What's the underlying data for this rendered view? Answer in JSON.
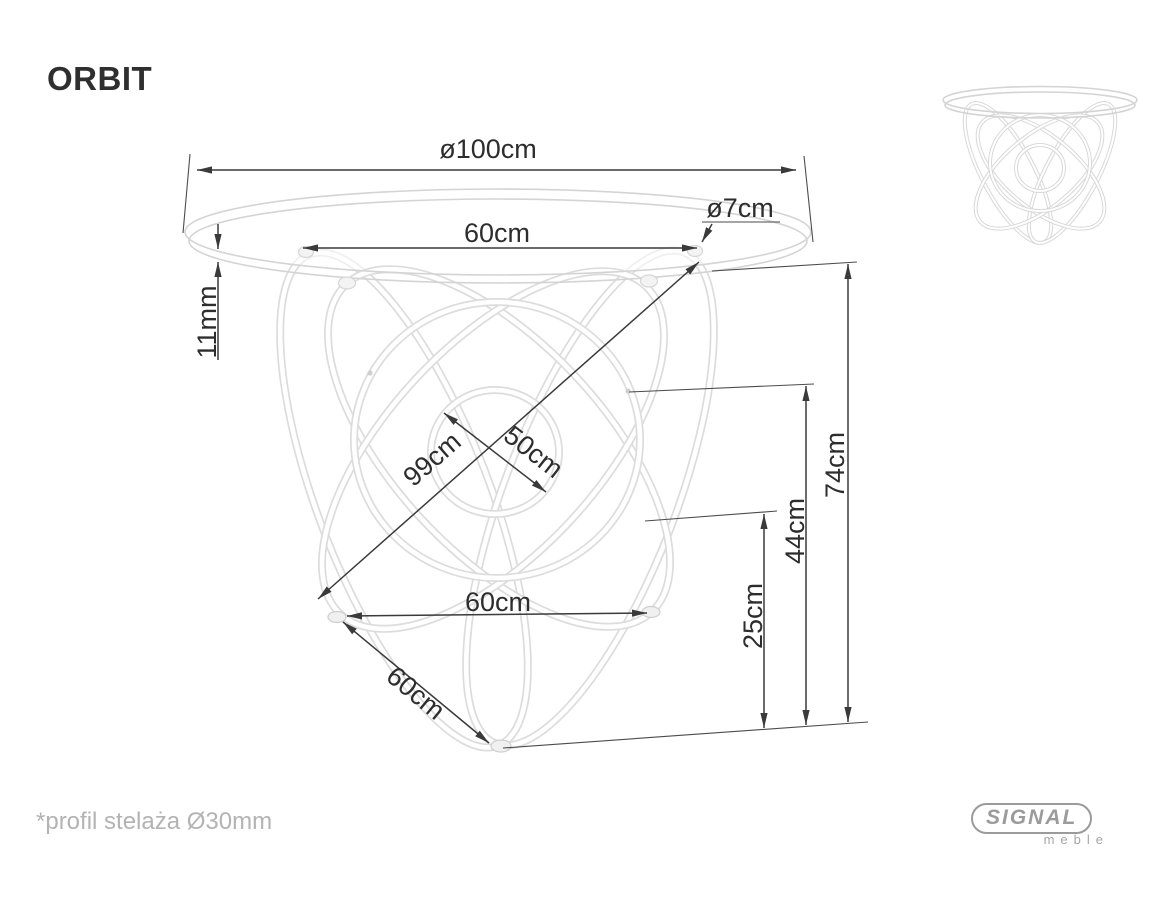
{
  "page": {
    "title": "ORBIT",
    "footnote": "*profil stelaża Ø30mm"
  },
  "logo": {
    "brand": "SIGNAL",
    "subtitle": "meble"
  },
  "drawing": {
    "dimensions": {
      "tabletop_diameter": "ø100cm",
      "top_mount_spacing": "60cm",
      "mount_disc_diameter": "ø7cm",
      "glass_thickness": "11mm",
      "base_diagonal": "99cm",
      "inner_ring_diameter": "50cm",
      "feet_spacing": "60cm",
      "foot_diagonal": "60cm",
      "total_height": "74cm",
      "mid_height": "44cm",
      "lower_height": "25cm"
    },
    "colors": {
      "dimension_line": "#3a3a3a",
      "label_text": "#2d2d2d",
      "furniture_line": "#dcdcdc",
      "muted_text": "#b3b3b3",
      "logo_gray": "#9b9b9b"
    }
  }
}
